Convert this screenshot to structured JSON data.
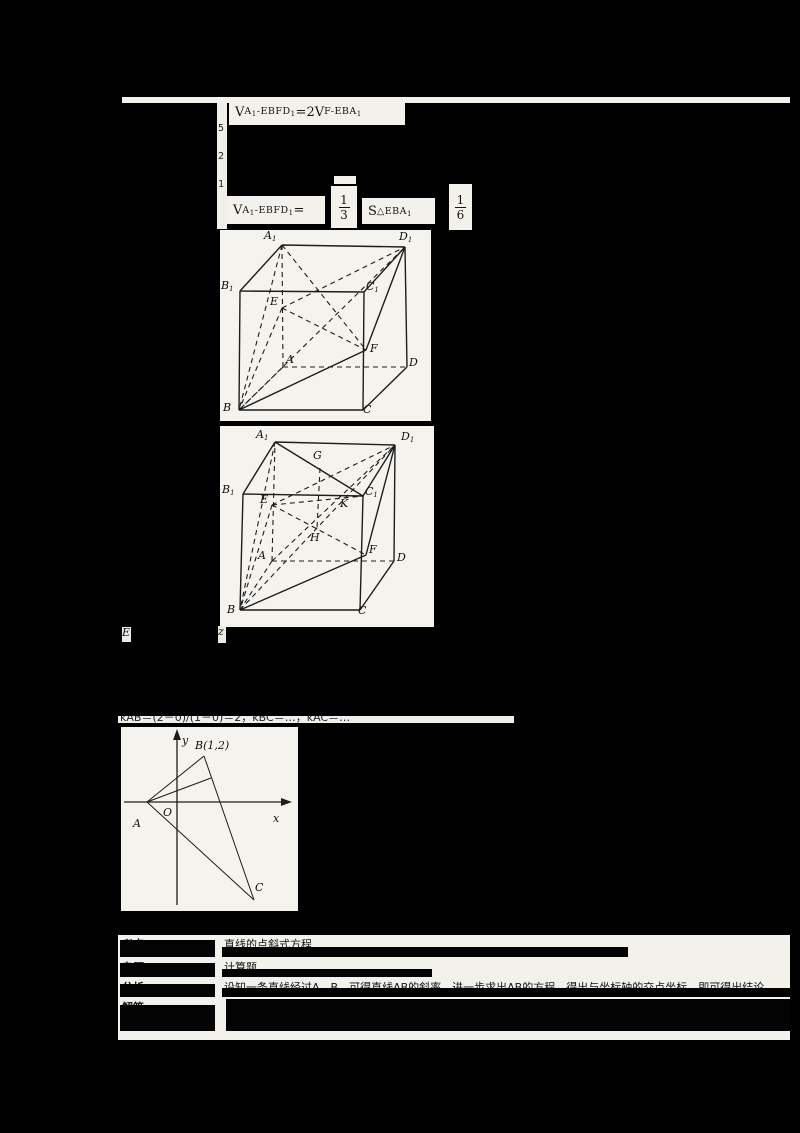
{
  "colors": {
    "background": "#000000",
    "paper": "#f2f1ec",
    "ink": "#141414"
  },
  "formulas": {
    "f1": {
      "t1": "V",
      "s1": "A₁-EBFD₁",
      "mid": "=2",
      "t2": "V",
      "s2": "F-EBA₁"
    },
    "f2": {
      "t1": "V",
      "s1": "A₁-EBFD₁",
      "eq": "=",
      "frac13": {
        "num": "1",
        "den": "3"
      },
      "t2": "S",
      "s2": "△EBA₁",
      "frac16": {
        "num": "1",
        "den": "6"
      }
    }
  },
  "margin": {
    "a": "5",
    "b": "2",
    "c": "1"
  },
  "strip": {
    "a": "E",
    "b": "z"
  },
  "clipped_line": "kAB＝(2－0)/(1－0)＝2，kBC＝…，kAC＝…",
  "figure1": {
    "labels": [
      {
        "t": "A₁",
        "x": 44,
        "y": 0
      },
      {
        "t": "D₁",
        "x": 179,
        "y": 1
      },
      {
        "t": "B₁",
        "x": 1,
        "y": 50
      },
      {
        "t": "C₁",
        "x": 146,
        "y": 51
      },
      {
        "t": "E",
        "x": 50,
        "y": 66
      },
      {
        "t": "A",
        "x": 66,
        "y": 124
      },
      {
        "t": "F",
        "x": 150,
        "y": 113
      },
      {
        "t": "D",
        "x": 189,
        "y": 127
      },
      {
        "t": "B",
        "x": 3,
        "y": 172
      },
      {
        "t": "C",
        "x": 143,
        "y": 174
      }
    ]
  },
  "figure2": {
    "labels": [
      {
        "t": "A₁",
        "x": 36,
        "y": 3
      },
      {
        "t": "D₁",
        "x": 181,
        "y": 5
      },
      {
        "t": "G",
        "x": 93,
        "y": 24
      },
      {
        "t": "B₁",
        "x": 2,
        "y": 58
      },
      {
        "t": "C₁",
        "x": 145,
        "y": 60
      },
      {
        "t": "E",
        "x": 40,
        "y": 68
      },
      {
        "t": "K",
        "x": 120,
        "y": 72
      },
      {
        "t": "H",
        "x": 90,
        "y": 106
      },
      {
        "t": "A",
        "x": 38,
        "y": 124
      },
      {
        "t": "F",
        "x": 149,
        "y": 118
      },
      {
        "t": "D",
        "x": 177,
        "y": 126
      },
      {
        "t": "B",
        "x": 7,
        "y": 178
      },
      {
        "t": "C",
        "x": 138,
        "y": 179
      }
    ]
  },
  "figure3": {
    "point_b": "B(1,2)",
    "labels": [
      {
        "t": "y",
        "x": 61,
        "y": 8
      },
      {
        "t": "x",
        "x": 152,
        "y": 86
      },
      {
        "t": "O",
        "x": 42,
        "y": 80
      },
      {
        "t": "A",
        "x": 12,
        "y": 91
      },
      {
        "t": "B(1,2)",
        "x": 74,
        "y": 13
      },
      {
        "t": "C",
        "x": 134,
        "y": 155
      }
    ]
  },
  "table": {
    "rows": [
      {
        "label": "考点",
        "content": "直线的点斜式方程"
      },
      {
        "label": "专题",
        "content": "计算题"
      },
      {
        "label": "分析",
        "content": "设知一条直线经过A、B，可得直线AB的斜率，进一步求出AB的方程，得出与坐标轴的交点坐标，即可得出结论"
      },
      {
        "label": "解答",
        "content": ""
      }
    ]
  }
}
